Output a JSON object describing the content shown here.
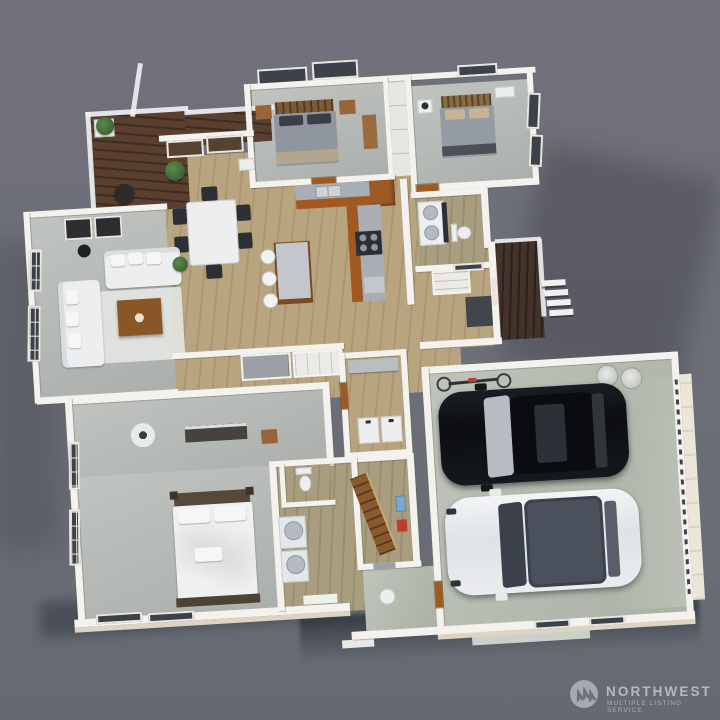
{
  "page": {
    "type": "3D aerial floor plan rendering",
    "background_color": "#6d7078",
    "view": "dollhouse top-down perspective, plan tilted slightly counter-clockwise"
  },
  "watermark": {
    "brand": "NORTHWEST",
    "tagline": "MULTIPLE LISTING SERVICE.",
    "icon": "pine-trees-circle-logo",
    "color": "#b3b9c1"
  },
  "floor_plan": {
    "rooms": [
      {
        "name": "Deck",
        "floor": "dark stained wood",
        "items": [
          "white mesh railing",
          "white planter with shrub",
          "dark bistro table"
        ]
      },
      {
        "name": "Living Room",
        "floor": "gray carpet",
        "items": [
          "two white sofas with pillows",
          "wood coffee table",
          "white area rug",
          "black floor lamp",
          "two framed artworks",
          "potted plant",
          "gridded french windows"
        ]
      },
      {
        "name": "Dining Area",
        "floor": "light oak plank",
        "items": [
          "white dining table",
          "six dark chairs",
          "potted plant",
          "dark picture windows"
        ]
      },
      {
        "name": "Kitchen",
        "floor": "light oak plank",
        "items": [
          "orange-wood cabinet runs",
          "gray counters",
          "double sink",
          "black cooktop with four burners",
          "tall corner cabinet",
          "island with gray top",
          "three white bar stools"
        ]
      },
      {
        "name": "Bedroom 2",
        "floor": "gray carpet",
        "items": [
          "bed with wood slat headboard",
          "dark pillows",
          "gray duvet with tan throw",
          "two wood nightstands",
          "two wall windows"
        ]
      },
      {
        "name": "Bedroom 3",
        "floor": "gray carpet",
        "items": [
          "bed with gray duvet and tan pillows",
          "white nightstand with lamp",
          "white dresser",
          "side-wall windows"
        ]
      },
      {
        "name": "Hall Bathroom",
        "floor": "light oak plank",
        "items": [
          "double-sink vanity with dark base",
          "toilet",
          "linen closet"
        ]
      },
      {
        "name": "Hallway",
        "floor": "light oak plank",
        "items": [
          "gray sliding-door closet",
          "white shelved closet"
        ]
      },
      {
        "name": "Laundry Room",
        "floor": "light oak plank",
        "items": [
          "wall shelf",
          "washer",
          "dryer",
          "wood door"
        ]
      },
      {
        "name": "Primary Bedroom",
        "floor": "gray carpet",
        "items": [
          "white bed with dark wood frame",
          "white pillows",
          "media console",
          "wood side table",
          "ceiling fan",
          "tall gridded windows"
        ]
      },
      {
        "name": "Primary Bathroom",
        "floor": "oak plank",
        "items": [
          "toilet nook",
          "two round-front vanity units",
          "bath mat"
        ]
      },
      {
        "name": "Utility Room",
        "floor": "oak plank",
        "items": [
          "wood staircase with rail",
          "blue electrical panel",
          "red wall box",
          "water heater"
        ]
      },
      {
        "name": "Entry Porch",
        "floor": "dark stained wood",
        "items": [
          "white railing",
          "four descending steps",
          "front door",
          "dark entry mat"
        ]
      },
      {
        "name": "Garage",
        "floor": "concrete",
        "items": [
          "black car",
          "white car",
          "wall-mounted bicycle",
          "two round bins",
          "paneled garage door on east wall",
          "two south wall windows"
        ]
      }
    ]
  },
  "colors": {
    "wall_white": "#f4f2ee",
    "exterior_trim": "#ddd4c3",
    "oak_floor": "#b9a480",
    "deck_wood": "#5a3f2f",
    "carpet": "#b6bab6",
    "garage_concrete": "#b8beb2",
    "cabinet_orange": "#a05a20",
    "car_black": "#14171b",
    "car_white": "#eaecef",
    "ground_shadow": "#3c424e"
  }
}
